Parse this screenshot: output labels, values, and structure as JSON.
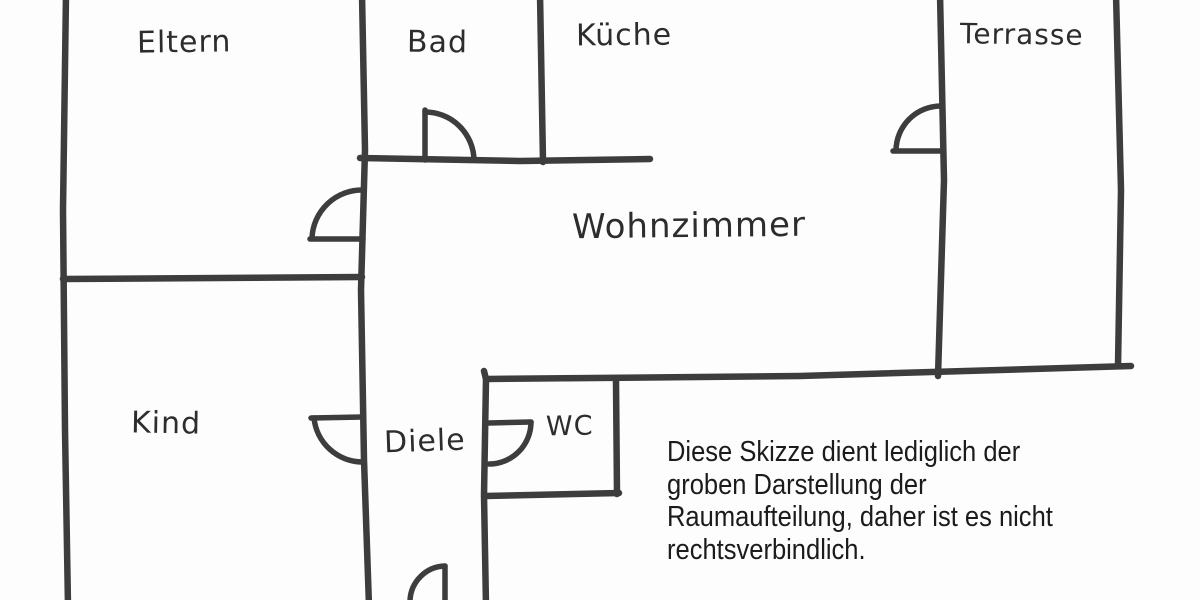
{
  "floorplan": {
    "rooms": {
      "eltern": "Eltern",
      "bad": "Bad",
      "kueche": "Küche",
      "terrasse": "Terrasse",
      "wohnzimmer": "Wohnzimmer",
      "kind": "Kind",
      "diele": "Diele",
      "wc": "WC"
    },
    "disclaimer": {
      "lines": [
        "Diese Skizze dient lediglich der",
        "groben Darstellung der",
        "Raumaufteilung, daher ist es nicht",
        "rechtsverbindlich."
      ]
    },
    "colors": {
      "ink": "#3d3d3d",
      "paper": "#fdfdfd",
      "disclaimer_text": "#1b1b1b"
    }
  }
}
